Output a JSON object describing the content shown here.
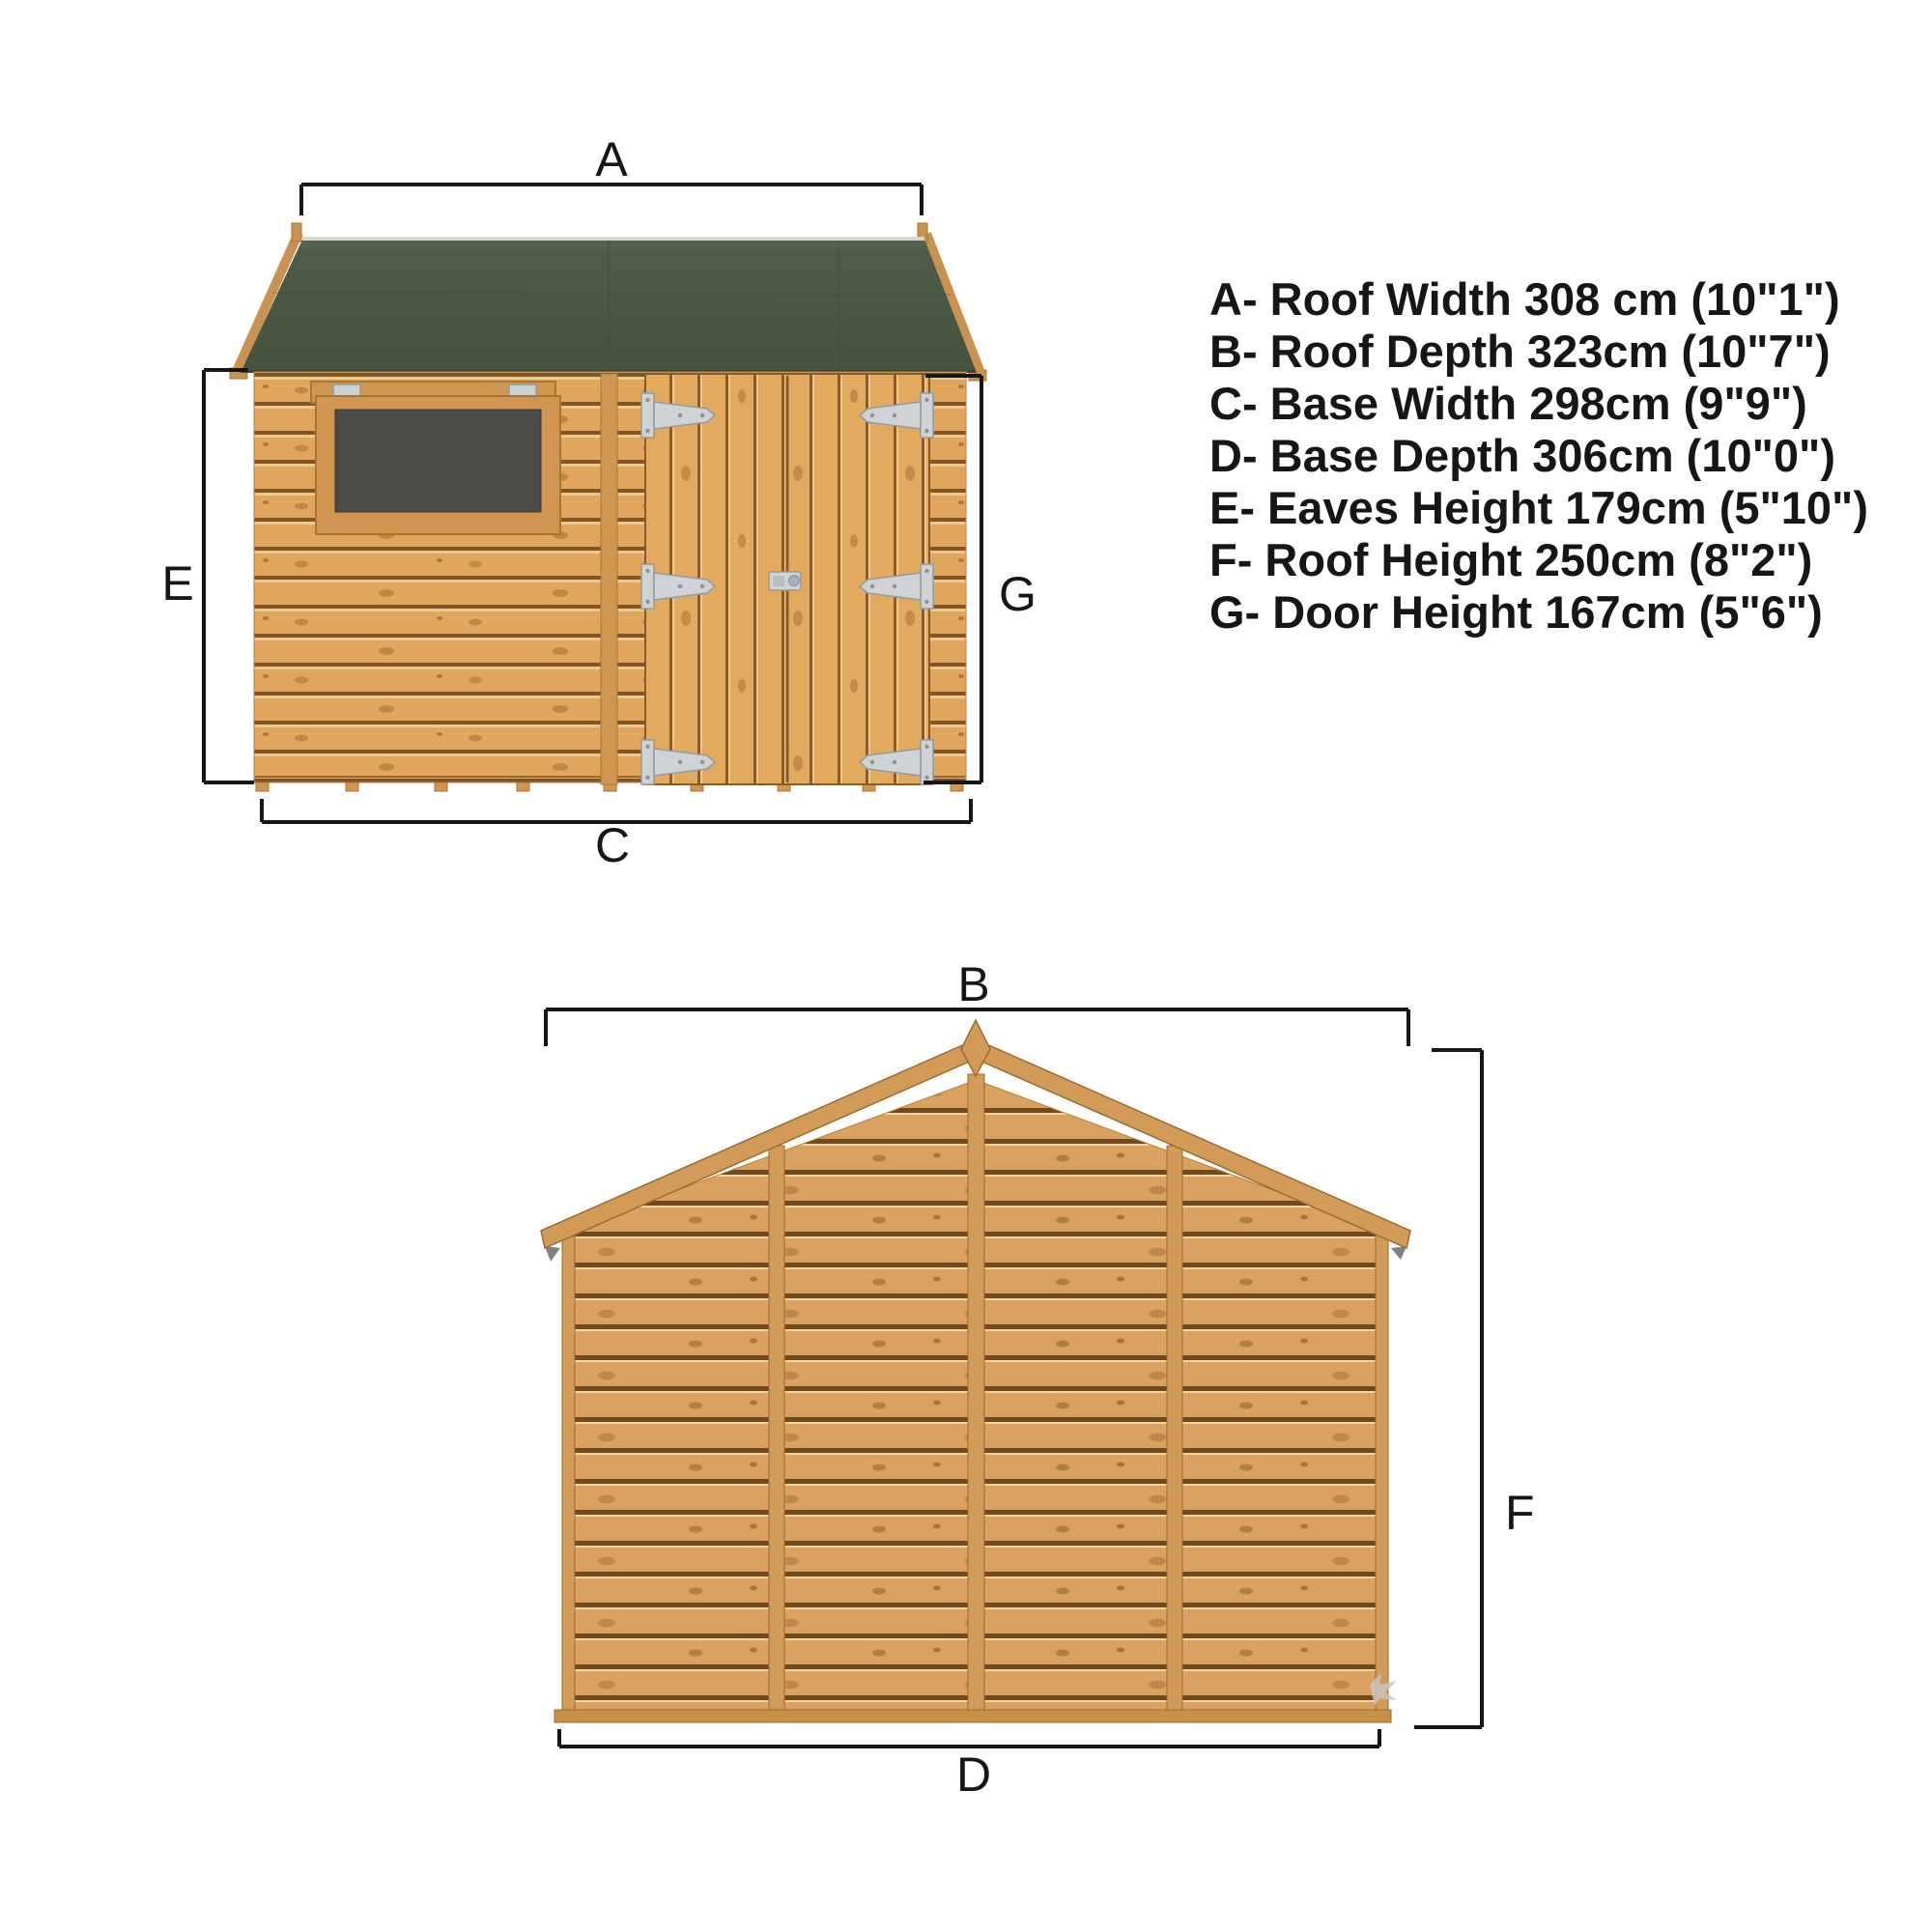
{
  "page": {
    "type": "shed dimension diagram",
    "background": "#ffffff"
  },
  "dim_labels": {
    "a": "A",
    "b": "B",
    "c": "C",
    "d": "D",
    "e": "E",
    "f": "F",
    "g": "G"
  },
  "legend": {
    "items": [
      {
        "key": "A",
        "label": "Roof Width",
        "metric": "308 cm",
        "imperial": "10\"1\"",
        "text": "A- Roof Width 308 cm (10\"1\")"
      },
      {
        "key": "B",
        "label": "Roof Depth",
        "metric": "323cm",
        "imperial": "10\"7\"",
        "text": "B- Roof Depth 323cm (10\"7\")"
      },
      {
        "key": "C",
        "label": "Base Width",
        "metric": "298cm",
        "imperial": "9\"9\"",
        "text": "C- Base Width 298cm (9\"9\")"
      },
      {
        "key": "D",
        "label": "Base Depth",
        "metric": "306cm",
        "imperial": "10\"0\"",
        "text": "D- Base Depth 306cm (10\"0\")"
      },
      {
        "key": "E",
        "label": "Eaves Height",
        "metric": "179cm",
        "imperial": "5\"10\"",
        "text": "E- Eaves Height 179cm (5\"10\")"
      },
      {
        "key": "F",
        "label": "Roof Height",
        "metric": "250cm",
        "imperial": "8\"2\"",
        "text": "F- Roof Height 250cm (8\"2\")"
      },
      {
        "key": "G",
        "label": "Door Height",
        "metric": "167cm",
        "imperial": "5\"6\"",
        "text": "G- Door Height 167cm (5\"6\")"
      }
    ]
  },
  "views": {
    "front": {
      "dims_shown": "A, E, G, C"
    },
    "side": {
      "dims_shown": "B, F, D"
    }
  },
  "colors": {
    "roof_green": "#4d5a48",
    "ridge_cap": "#d8d8d2",
    "wood_board": "#dfa65c",
    "wood_gap": "#855423",
    "wood_trim": "#cf9551",
    "glazing": "#4b4a47",
    "metal": "#cfd3d6",
    "dimension_line": "#161616"
  }
}
